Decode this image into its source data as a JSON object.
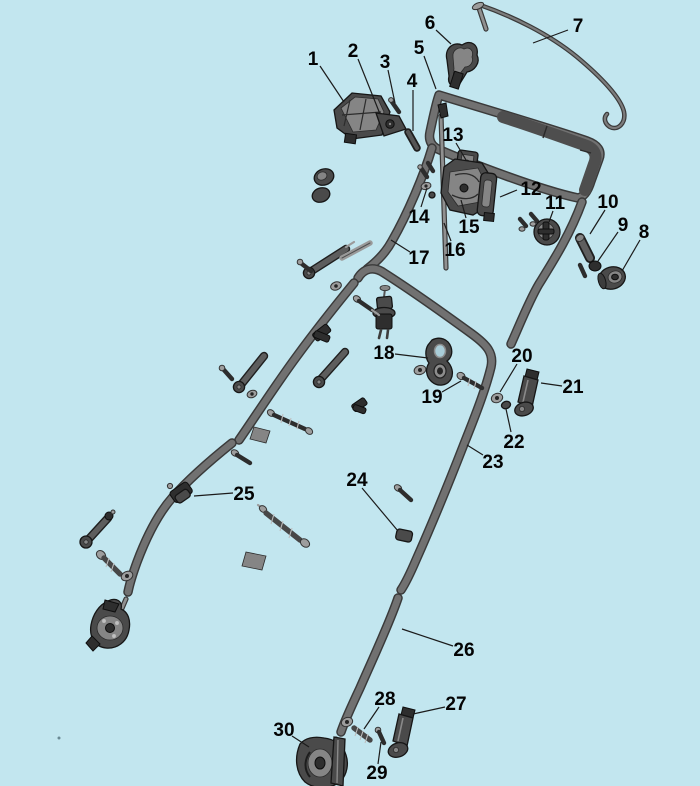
{
  "diagram": {
    "type": "exploded-parts-diagram",
    "subject": "lawn mower handle assembly",
    "background_color": "#c2e6ef",
    "label_color": "#040404",
    "leader_color": "#1b1b1b",
    "tube_color": "#717171",
    "part_dark_color": "#4a4a4a",
    "callouts": [
      {
        "label": "1",
        "x": 313,
        "y": 58,
        "line": [
          320,
          66,
          344,
          102
        ]
      },
      {
        "label": "2",
        "x": 353,
        "y": 50,
        "line": [
          358,
          59,
          380,
          114
        ]
      },
      {
        "label": "3",
        "x": 385,
        "y": 61,
        "line": [
          388,
          70,
          395,
          103
        ]
      },
      {
        "label": "4",
        "x": 412,
        "y": 80,
        "line": [
          413,
          90,
          413,
          131
        ]
      },
      {
        "label": "5",
        "x": 419,
        "y": 47,
        "line": [
          424,
          56,
          436,
          89
        ]
      },
      {
        "label": "6",
        "x": 430,
        "y": 22,
        "line": [
          436,
          30,
          451,
          44
        ]
      },
      {
        "label": "7",
        "x": 578,
        "y": 25,
        "line": [
          568,
          30,
          533,
          43
        ]
      },
      {
        "label": "8",
        "x": 644,
        "y": 231,
        "line": [
          640,
          240,
          622,
          271
        ]
      },
      {
        "label": "9",
        "x": 623,
        "y": 224,
        "line": [
          618,
          232,
          598,
          261
        ]
      },
      {
        "label": "10",
        "x": 608,
        "y": 201,
        "line": [
          605,
          210,
          590,
          234
        ]
      },
      {
        "label": "11",
        "x": 555,
        "y": 202,
        "line": [
          553,
          211,
          549,
          222
        ]
      },
      {
        "label": "12",
        "x": 531,
        "y": 188,
        "line": [
          517,
          190,
          500,
          197
        ]
      },
      {
        "label": "13",
        "x": 453,
        "y": 134,
        "line": [
          456,
          143,
          466,
          160
        ]
      },
      {
        "label": "14",
        "x": 419,
        "y": 216,
        "line": [
          421,
          207,
          427,
          188
        ]
      },
      {
        "label": "15",
        "x": 469,
        "y": 226,
        "line": [
          466,
          218,
          461,
          200
        ]
      },
      {
        "label": "16",
        "x": 455,
        "y": 249,
        "line": [
          451,
          241,
          444,
          223
        ]
      },
      {
        "label": "17",
        "x": 419,
        "y": 257,
        "line": [
          410,
          252,
          391,
          240
        ]
      },
      {
        "label": "18",
        "x": 384,
        "y": 352,
        "line": [
          395,
          354,
          428,
          358
        ]
      },
      {
        "label": "19",
        "x": 432,
        "y": 396,
        "line": [
          442,
          392,
          461,
          381
        ]
      },
      {
        "label": "20",
        "x": 522,
        "y": 355,
        "line": [
          517,
          364,
          500,
          392
        ]
      },
      {
        "label": "21",
        "x": 573,
        "y": 386,
        "line": [
          562,
          386,
          541,
          383
        ]
      },
      {
        "label": "22",
        "x": 514,
        "y": 441,
        "line": [
          511,
          432,
          506,
          409
        ]
      },
      {
        "label": "23",
        "x": 493,
        "y": 461,
        "line": [
          483,
          455,
          467,
          445
        ]
      },
      {
        "label": "24",
        "x": 357,
        "y": 479,
        "line": [
          362,
          488,
          398,
          531
        ]
      },
      {
        "label": "25",
        "x": 244,
        "y": 493,
        "line": [
          233,
          493,
          194,
          496
        ]
      },
      {
        "label": "26",
        "x": 464,
        "y": 649,
        "line": [
          453,
          646,
          402,
          629
        ]
      },
      {
        "label": "27",
        "x": 456,
        "y": 703,
        "line": [
          445,
          707,
          413,
          714
        ]
      },
      {
        "label": "28",
        "x": 385,
        "y": 698,
        "line": [
          379,
          707,
          364,
          729
        ]
      },
      {
        "label": "29",
        "x": 377,
        "y": 772,
        "line": [
          378,
          764,
          381,
          742
        ]
      },
      {
        "label": "30",
        "x": 284,
        "y": 729,
        "line": [
          292,
          736,
          309,
          747
        ]
      }
    ]
  }
}
